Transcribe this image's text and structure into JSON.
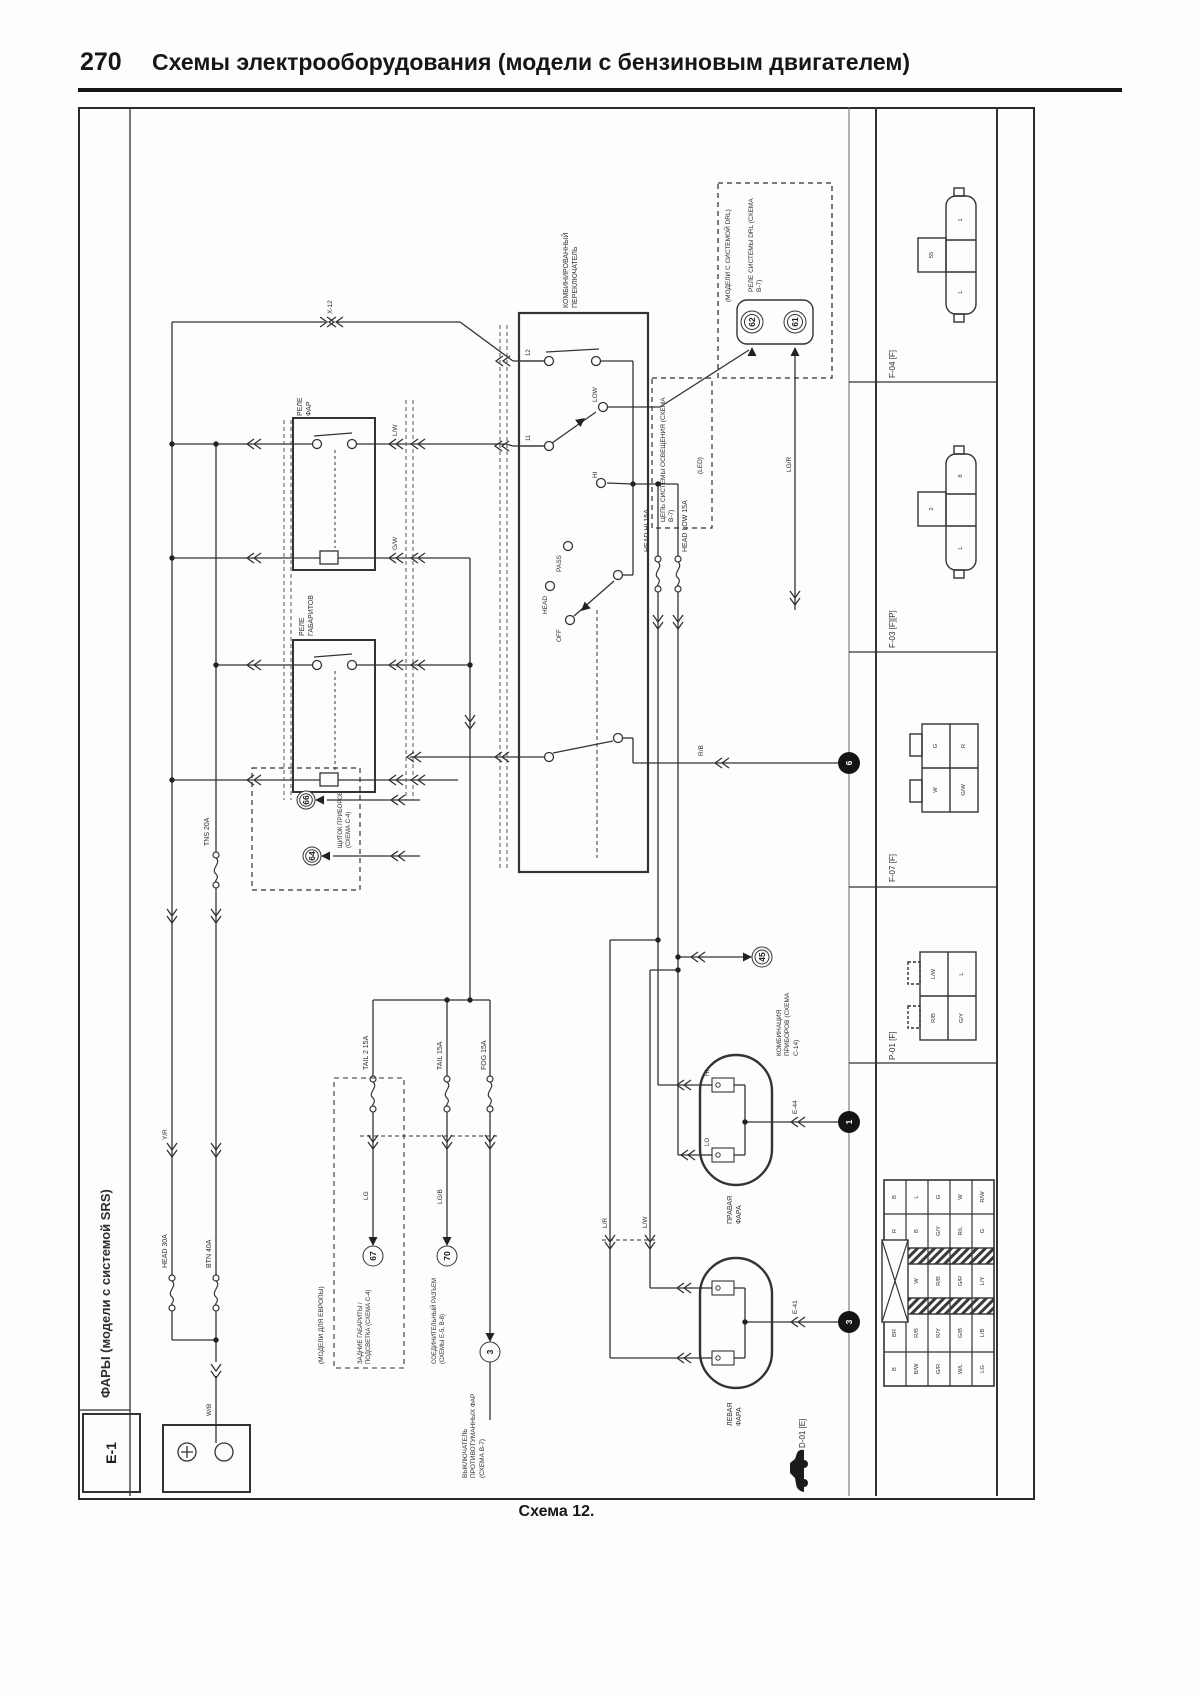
{
  "page": {
    "number": "270",
    "title": "Схемы электрооборудования (модели с бензиновым двигателем)",
    "caption": "Схема 12."
  },
  "sidebar": {
    "label": "ФАРЫ (модели с системой SRS)",
    "sheet_code": "E-1"
  },
  "components": {
    "combo_switch": "КОМБИНИРОВАННЫЙ ПЕРЕКЛЮЧАТЕЛЬ",
    "relay_head": "РЕЛЕ ФАР",
    "relay_tns": "РЕЛЕ ГАБАРИТОВ",
    "drl_relay": "РЕЛЕ СИСТЕМЫ DRL (СХЕМА В-7)",
    "drl_models": "(МОДЕЛИ С СИСТЕМОЙ DRL)",
    "light_circuit": "ЦЕПЬ СИСТЕМЫ ОСВЕЩЕНИЯ (СХЕМА В-7)",
    "led": "(LED)",
    "euro_models": "(МОДЕЛИ ДЛЯ ЕВРОПЫ)",
    "lamp_right": "ПРАВАЯ ФАРА",
    "lamp_left": "ЛЕВАЯ ФАРА",
    "cluster_ref": "ЩИТОК ПРИБОРОВ (СХЕМА С-4)",
    "gauge_ref": "КОМБИНАЦИЯ ПРИБОРОВ (СХЕМА С-14)",
    "tail_ref": "ЗАДНИЕ ГАБАРИТЫ / ПОДСВЕТКА (СХЕМА С-4)",
    "joint_ref": "СОЕДИНИТЕЛЬНЫЙ РАЗЪЕМ (СХЕМЫ Е-5, В-8)",
    "fog_ref": "ВЫКЛЮЧАТЕЛЬ ПРОТИВОТУМАННЫХ ФАР (СХЕМА В-7)"
  },
  "fuses": {
    "head": "HEAD 30A",
    "btn": "BTN 40A",
    "tns": "TNS 20A",
    "head_hi": "HEAD HI 15A",
    "head_low": "HEAD LOW 15A",
    "tail2": "TAIL 2 15A",
    "tail": "TAIL 15A",
    "fog": "FOG 15A"
  },
  "switch": {
    "low": "LOW",
    "hi": "HI",
    "pass": "PASS",
    "head": "HEAD",
    "off": "OFF",
    "t12": "12",
    "t11": "11"
  },
  "wire_codes": {
    "wb": "W/B",
    "yr": "Y/R",
    "lgr": "LG/R",
    "lw": "L/W",
    "gw": "G/W",
    "lr": "L/R",
    "lw2": "L/W",
    "rb": "R/B",
    "lg": "LG",
    "lgb": "LG/B",
    "x12": "X-12",
    "e44": "Е-44",
    "e41": "Е-41",
    "hi": "HI",
    "lo": "LO"
  },
  "ref_circles": {
    "c62": "62",
    "c61": "61",
    "c66": "66",
    "c64": "64",
    "c45": "45",
    "c67": "67",
    "c70": "70",
    "c3": "3",
    "j6": "6",
    "j1": "1",
    "j3": "3"
  },
  "right_panel": {
    "sections": [
      {
        "label": "F-04 [F]",
        "tab": "55",
        "pin_top": "1",
        "pin_bottom": "L"
      },
      {
        "label": "F-03 [F][P]",
        "tab": "2",
        "pin_top": "8",
        "pin_bottom": "L"
      },
      {
        "label": "F-07 [F]",
        "cells": [
          "G",
          "R",
          "W",
          "G/W"
        ]
      },
      {
        "label": "P-01 [F]",
        "cells": [
          "L/W",
          "L",
          "R/B",
          "G/Y"
        ]
      },
      {
        "label": "D-01 [E]"
      }
    ],
    "pin_grid_rows": [
      [
        "B",
        "L",
        "G",
        "W",
        "R/W"
      ],
      [
        "R",
        "B",
        "G/Y",
        "R/L",
        "G"
      ],
      [
        "W",
        "R/B",
        "G/R",
        "L/Y"
      ],
      [
        "BR",
        "R/B",
        "R/Y",
        "G/B",
        "L/B"
      ],
      [
        "B",
        "B/W",
        "G/R",
        "W/L",
        "LG"
      ]
    ]
  }
}
